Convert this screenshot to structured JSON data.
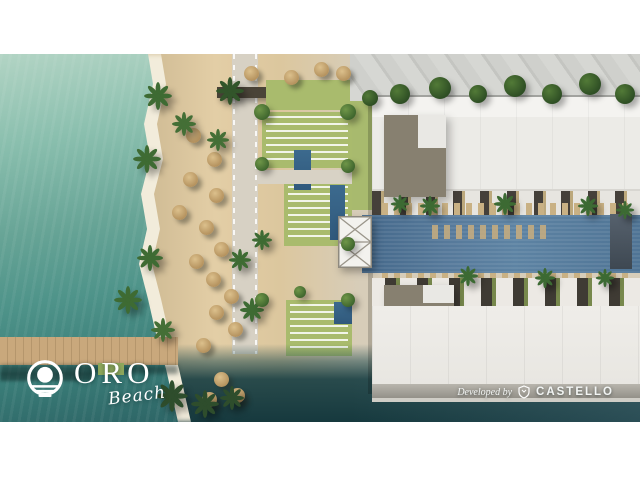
{
  "branding": {
    "logo": {
      "name": "ORO",
      "tagline": "Beach",
      "icon": "sun-over-waves-icon",
      "color": "#ffffff"
    },
    "developer": {
      "prefix": "Developed by",
      "name": "CASTELLO",
      "icon": "castello-crest-icon",
      "color": "#ffffff"
    }
  },
  "scene": {
    "type": "aerial-architectural-render",
    "elements": [
      "lagoon",
      "surf-line",
      "sandy-beach",
      "beach-umbrellas",
      "palm-trees",
      "boardwalk-pier",
      "lawn-lounger-fields",
      "plunge-pools",
      "canopy-tent",
      "promenade",
      "long-pool",
      "residence-row-north",
      "residence-row-south",
      "villa-rooftops",
      "deep-water-shoreline"
    ]
  },
  "palette": {
    "letterbox": "#ffffff",
    "water_shallow": "#a9cfc0",
    "water_deep": "#1f4b4f",
    "sand": "#dcc79e",
    "lawn": "#a9bb6d",
    "pool": "#56799a",
    "building_white": "#ecebe7",
    "building_grey": "#878070",
    "pier_wood": "#c9a87c"
  }
}
